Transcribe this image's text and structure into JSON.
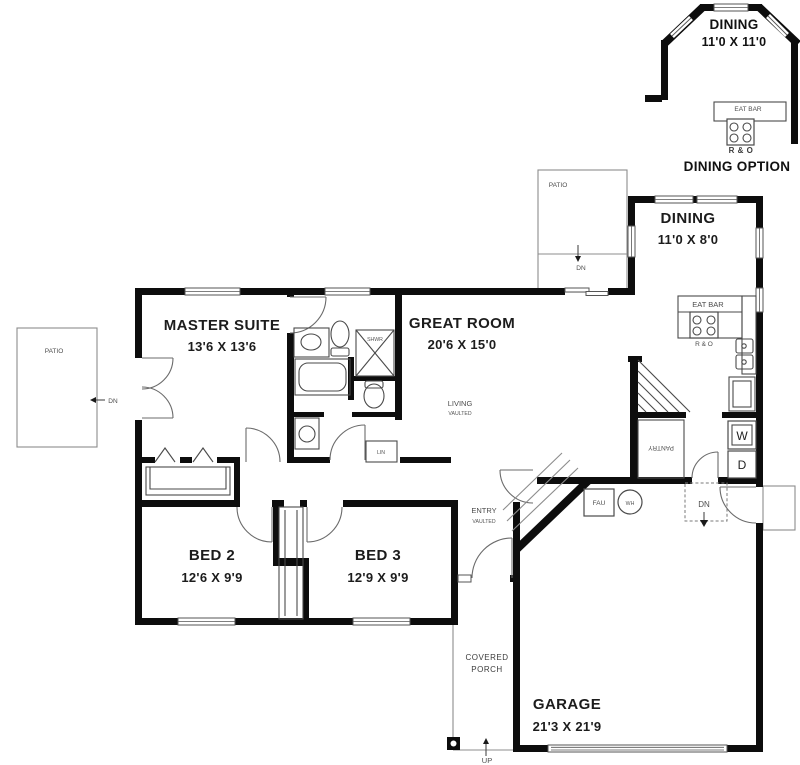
{
  "inset": {
    "room": "DINING",
    "dims": "11'0 X 11'0",
    "counter": "EAT BAR",
    "appliance": "R & O",
    "caption": "DINING OPTION"
  },
  "rooms": {
    "dining": {
      "name": "DINING",
      "dims": "11'0 X 8'0"
    },
    "master": {
      "name": "MASTER SUITE",
      "dims": "13'6 X 13'6"
    },
    "great": {
      "name": "GREAT ROOM",
      "dims": "20'6 X 15'0",
      "note1": "LIVING",
      "note2": "VAULTED"
    },
    "bed2": {
      "name": "BED 2",
      "dims": "12'6 X 9'9"
    },
    "bed3": {
      "name": "BED 3",
      "dims": "12'9 X 9'9"
    },
    "entry": {
      "name": "ENTRY",
      "note": "VAULTED"
    },
    "garage": {
      "name": "GARAGE",
      "dims": "21'3 X 21'9"
    },
    "porch": {
      "line1": "COVERED",
      "line2": "PORCH"
    }
  },
  "kitchen": {
    "counter": "EAT BAR",
    "appliance": "R & O",
    "pantry": "PANTRY",
    "washer": "W",
    "dryer": "D"
  },
  "labels": {
    "patio": "PATIO",
    "dn": "DN",
    "up": "UP",
    "lin": "LIN",
    "fau": "FAU",
    "wh": "WH",
    "shower": "SHWR"
  },
  "colors": {
    "wall": "#0d0d0d",
    "thin_line": "#8c8c8c",
    "background": "#ffffff"
  }
}
